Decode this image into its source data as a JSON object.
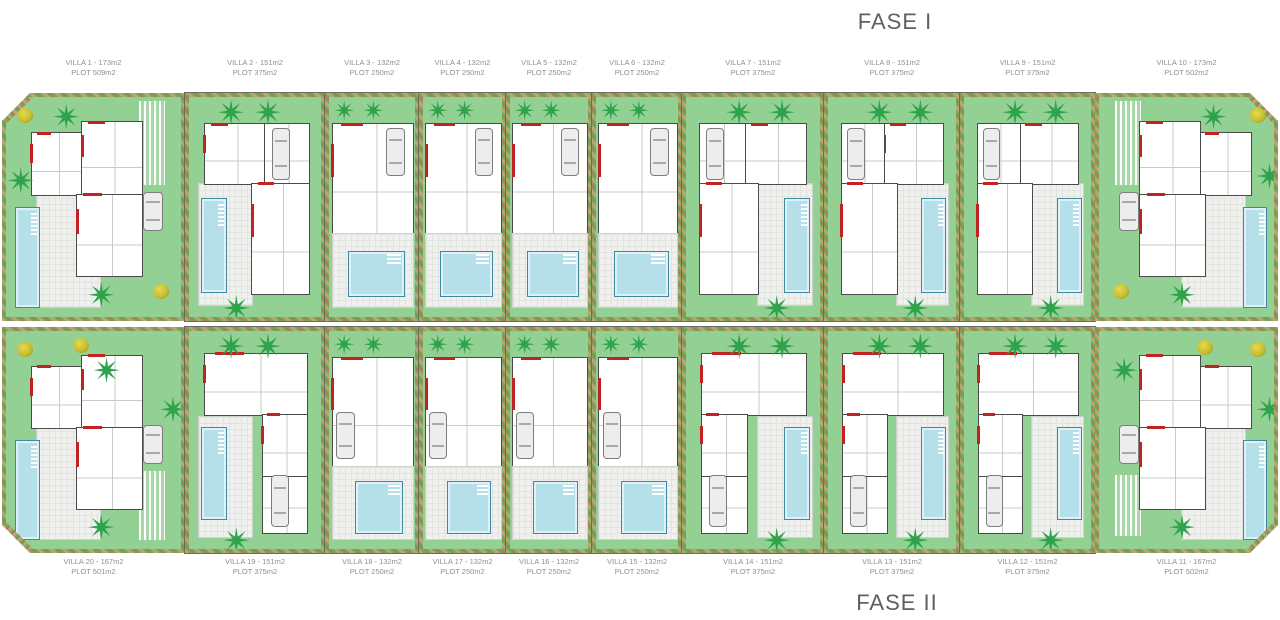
{
  "titles": {
    "phase1": "FASE I",
    "phase2": "FASE II"
  },
  "colors": {
    "garden": "#93d093",
    "palm": "#2fa24c",
    "bush": "#c9bd30",
    "pool": "#b5e0ea",
    "poolline": "#3f89a1",
    "paving": "#f0f1ee",
    "wall": "#4a4a48",
    "red": "#c22222",
    "hedge1": "#c4a277",
    "hedge2": "#6fae57",
    "hedge3": "#a87e55",
    "labeltxt": "#8f8f8f",
    "title": "#5f5f5f"
  },
  "rows": [
    {
      "phase": "FASE I",
      "villas": [
        {
          "name": "VILLA 1",
          "area": "173m2",
          "plot": "509m2",
          "label1": "VILLA 1 - 173m2",
          "label2": "PLOT 509m2",
          "type": "corner-left",
          "width": 183
        },
        {
          "name": "VILLA 2",
          "area": "151m2",
          "plot": "375m2",
          "label1": "VILLA 2 - 151m2",
          "label2": "PLOT 375m2",
          "type": "wide-left",
          "width": 140
        },
        {
          "name": "VILLA 3",
          "area": "132m2",
          "plot": "250m2",
          "label1": "VILLA 3 - 132m2",
          "label2": "PLOT 250m2",
          "type": "narrow",
          "width": 94
        },
        {
          "name": "VILLA 4",
          "area": "132m2",
          "plot": "250m2",
          "label1": "VILLA 4 - 132m2",
          "label2": "PLOT 250m2",
          "type": "narrow",
          "width": 87
        },
        {
          "name": "VILLA 5",
          "area": "132m2",
          "plot": "250m2",
          "label1": "VILLA 5 - 132m2",
          "label2": "PLOT 250m2",
          "type": "narrow",
          "width": 86
        },
        {
          "name": "VILLA 6",
          "area": "132m2",
          "plot": "250m2",
          "label1": "VILLA 6 - 132m2",
          "label2": "PLOT 250m2",
          "type": "narrow",
          "width": 90
        },
        {
          "name": "VILLA 7",
          "area": "151m2",
          "plot": "375m2",
          "label1": "VILLA 7 - 151m2",
          "label2": "PLOT 375m2",
          "type": "wide-right",
          "width": 142
        },
        {
          "name": "VILLA 8",
          "area": "151m2",
          "plot": "375m2",
          "label1": "VILLA 8 - 151m2",
          "label2": "PLOT 375m2",
          "type": "wide-right",
          "width": 136
        },
        {
          "name": "VILLA 9",
          "area": "151m2",
          "plot": "375m2",
          "label1": "VILLA 9 - 151m2",
          "label2": "PLOT 375m2",
          "type": "wide-right",
          "width": 135
        },
        {
          "name": "VILLA 10",
          "area": "173m2",
          "plot": "502m2",
          "label1": "VILLA 10 - 173m2",
          "label2": "PLOT 502m2",
          "type": "corner-right",
          "width": 183
        }
      ]
    },
    {
      "phase": "FASE II",
      "villas": [
        {
          "name": "VILLA 20",
          "area": "167m2",
          "plot": "501m2",
          "label1": "VILLA 20 - 167m2",
          "label2": "PLOT 501m2",
          "type": "corner-left",
          "width": 183
        },
        {
          "name": "VILLA 19",
          "area": "151m2",
          "plot": "375m2",
          "label1": "VILLA 19 - 151m2",
          "label2": "PLOT 375m2",
          "type": "wide-left",
          "width": 140
        },
        {
          "name": "VILLA 18",
          "area": "132m2",
          "plot": "250m2",
          "label1": "VILLA 18 - 132m2",
          "label2": "PLOT 250m2",
          "type": "narrow",
          "width": 94
        },
        {
          "name": "VILLA 17",
          "area": "132m2",
          "plot": "250m2",
          "label1": "VILLA 17 - 132m2",
          "label2": "PLOT 250m2",
          "type": "narrow",
          "width": 87
        },
        {
          "name": "VILLA 16",
          "area": "132m2",
          "plot": "250m2",
          "label1": "VILLA 16 - 132m2",
          "label2": "PLOT 250m2",
          "type": "narrow",
          "width": 86
        },
        {
          "name": "VILLA 15",
          "area": "132m2",
          "plot": "250m2",
          "label1": "VILLA 15 - 132m2",
          "label2": "PLOT 250m2",
          "type": "narrow",
          "width": 90
        },
        {
          "name": "VILLA 14",
          "area": "151m2",
          "plot": "375m2",
          "label1": "VILLA 14 - 151m2",
          "label2": "PLOT 375m2",
          "type": "wide-right",
          "width": 142
        },
        {
          "name": "VILLA 13",
          "area": "151m2",
          "plot": "375m2",
          "label1": "VILLA 13 - 151m2",
          "label2": "PLOT 375m2",
          "type": "wide-right",
          "width": 136
        },
        {
          "name": "VILLA 12",
          "area": "151m2",
          "plot": "375m2",
          "label1": "VILLA 12 - 151m2",
          "label2": "PLOT 375m2",
          "type": "wide-right",
          "width": 135
        },
        {
          "name": "VILLA 11",
          "area": "167m2",
          "plot": "502m2",
          "label1": "VILLA 11 - 167m2",
          "label2": "PLOT 502m2",
          "type": "corner-right",
          "width": 183
        }
      ]
    }
  ]
}
